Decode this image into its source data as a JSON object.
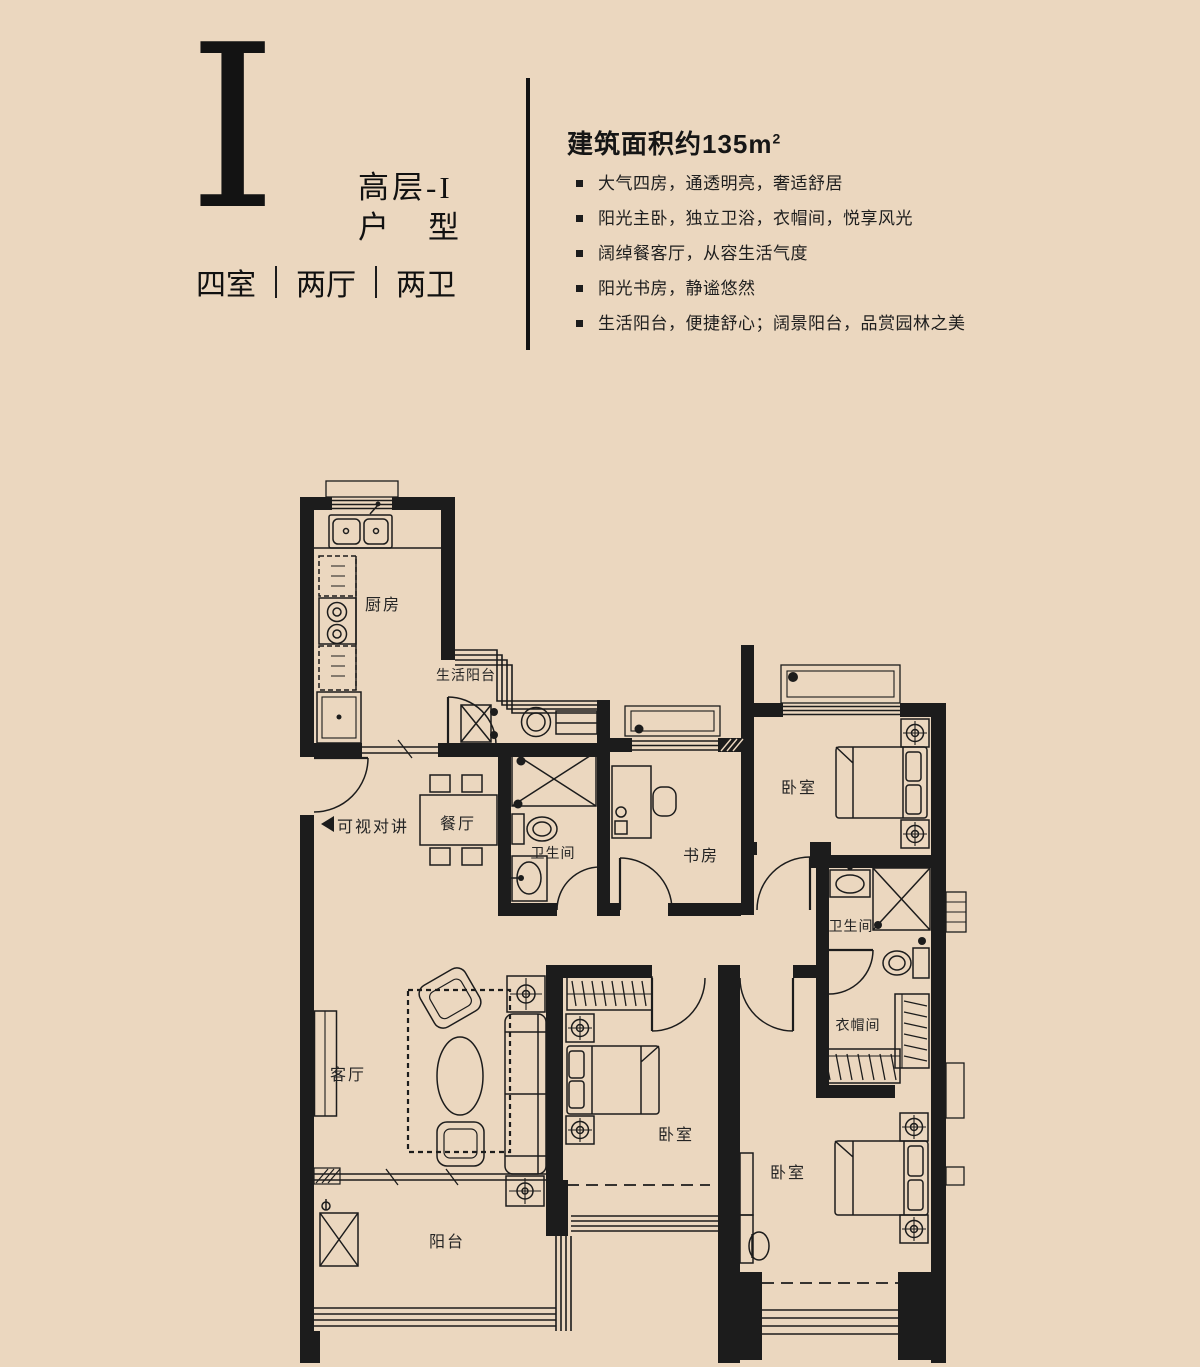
{
  "colors": {
    "background": "#ebd7bf",
    "ink": "#1c1c1c"
  },
  "header": {
    "logo": "I",
    "type_name": "高层-I",
    "type_label": "户　型",
    "rooms": [
      "四室",
      "两厅",
      "两卫"
    ]
  },
  "specs": {
    "area_title": "建筑面积约135m",
    "area_sup": "2",
    "bullets": [
      "大气四房，通透明亮，奢适舒居",
      "阳光主卧，独立卫浴，衣帽间，悦享风光",
      "阔绰餐客厅，从容生活气度",
      "阳光书房，静谧悠然",
      "生活阳台，便捷舒心；阔景阳台，品赏园林之美"
    ]
  },
  "plan": {
    "rooms": {
      "kitchen": "厨房",
      "service_balcony": "生活阳台",
      "dining": "餐厅",
      "bath1": "卫生间",
      "study": "书房",
      "bedroom_top": "卧室",
      "bath2": "卫生间",
      "cloakroom": "衣帽间",
      "bedroom_mid": "卧室",
      "bedroom_master": "卧室",
      "living": "客厅",
      "balcony": "阳台",
      "intercom": "可视对讲"
    }
  }
}
